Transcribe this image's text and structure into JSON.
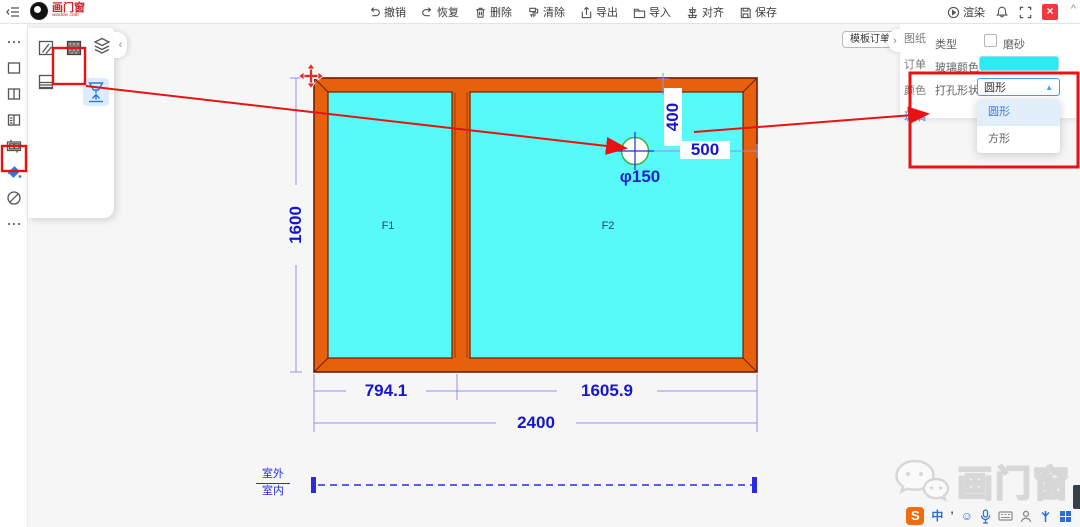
{
  "topbar": {
    "logo": {
      "title": "画门窗",
      "subtitle": "window craft"
    },
    "tools": [
      {
        "label": "撤销"
      },
      {
        "label": "恢复"
      },
      {
        "label": "删除"
      },
      {
        "label": "清除"
      },
      {
        "label": "导出"
      },
      {
        "label": "导入"
      },
      {
        "label": "对齐"
      },
      {
        "label": "保存"
      }
    ],
    "render_label": "渲染",
    "close_glyph": "×",
    "scroll_caret": "^"
  },
  "toolbox": {
    "template_order_label": "模板订单",
    "panel_collapse_glyph": "›",
    "flyout_collapse_glyph": "‹"
  },
  "right_panel": {
    "tabs": [
      {
        "label": "图纸"
      },
      {
        "label": "订单"
      },
      {
        "label": "颜色"
      },
      {
        "label": "玻璃"
      }
    ],
    "type_label": "类型",
    "frosted_label": "磨砂",
    "glass_color_label": "玻璃颜色",
    "glass_color": "#2BEAF2",
    "hole_shape_label": "打孔形状",
    "hole_shape_value": "圆形",
    "caret_glyph": "▲",
    "options": [
      {
        "label": "圆形"
      },
      {
        "label": "方形"
      }
    ]
  },
  "drawing": {
    "panes": [
      {
        "label": "F1"
      },
      {
        "label": "F2"
      }
    ],
    "hole_label": "φ150",
    "dims": {
      "total_width": "2400",
      "left_width": "794.1",
      "right_width": "1605.9",
      "height": "1600",
      "hole_top": "400",
      "hole_right": "500"
    },
    "outside_label": "室外",
    "inside_label": "室内"
  },
  "watermark": {
    "text": "画门窗"
  },
  "taskbar": {
    "ime": "S",
    "lang": "中",
    "punct": "’",
    "emoji": "☺"
  },
  "colors": {
    "accent_blue": "#409EFF",
    "annotation_red": "#E81212",
    "frame_orange": "#E7600B",
    "glass_cyan": "#57F8F8",
    "dim_blue": "#1616CC",
    "close_red": "#F5383F",
    "active_tab_blue": "#2A7AE4"
  }
}
